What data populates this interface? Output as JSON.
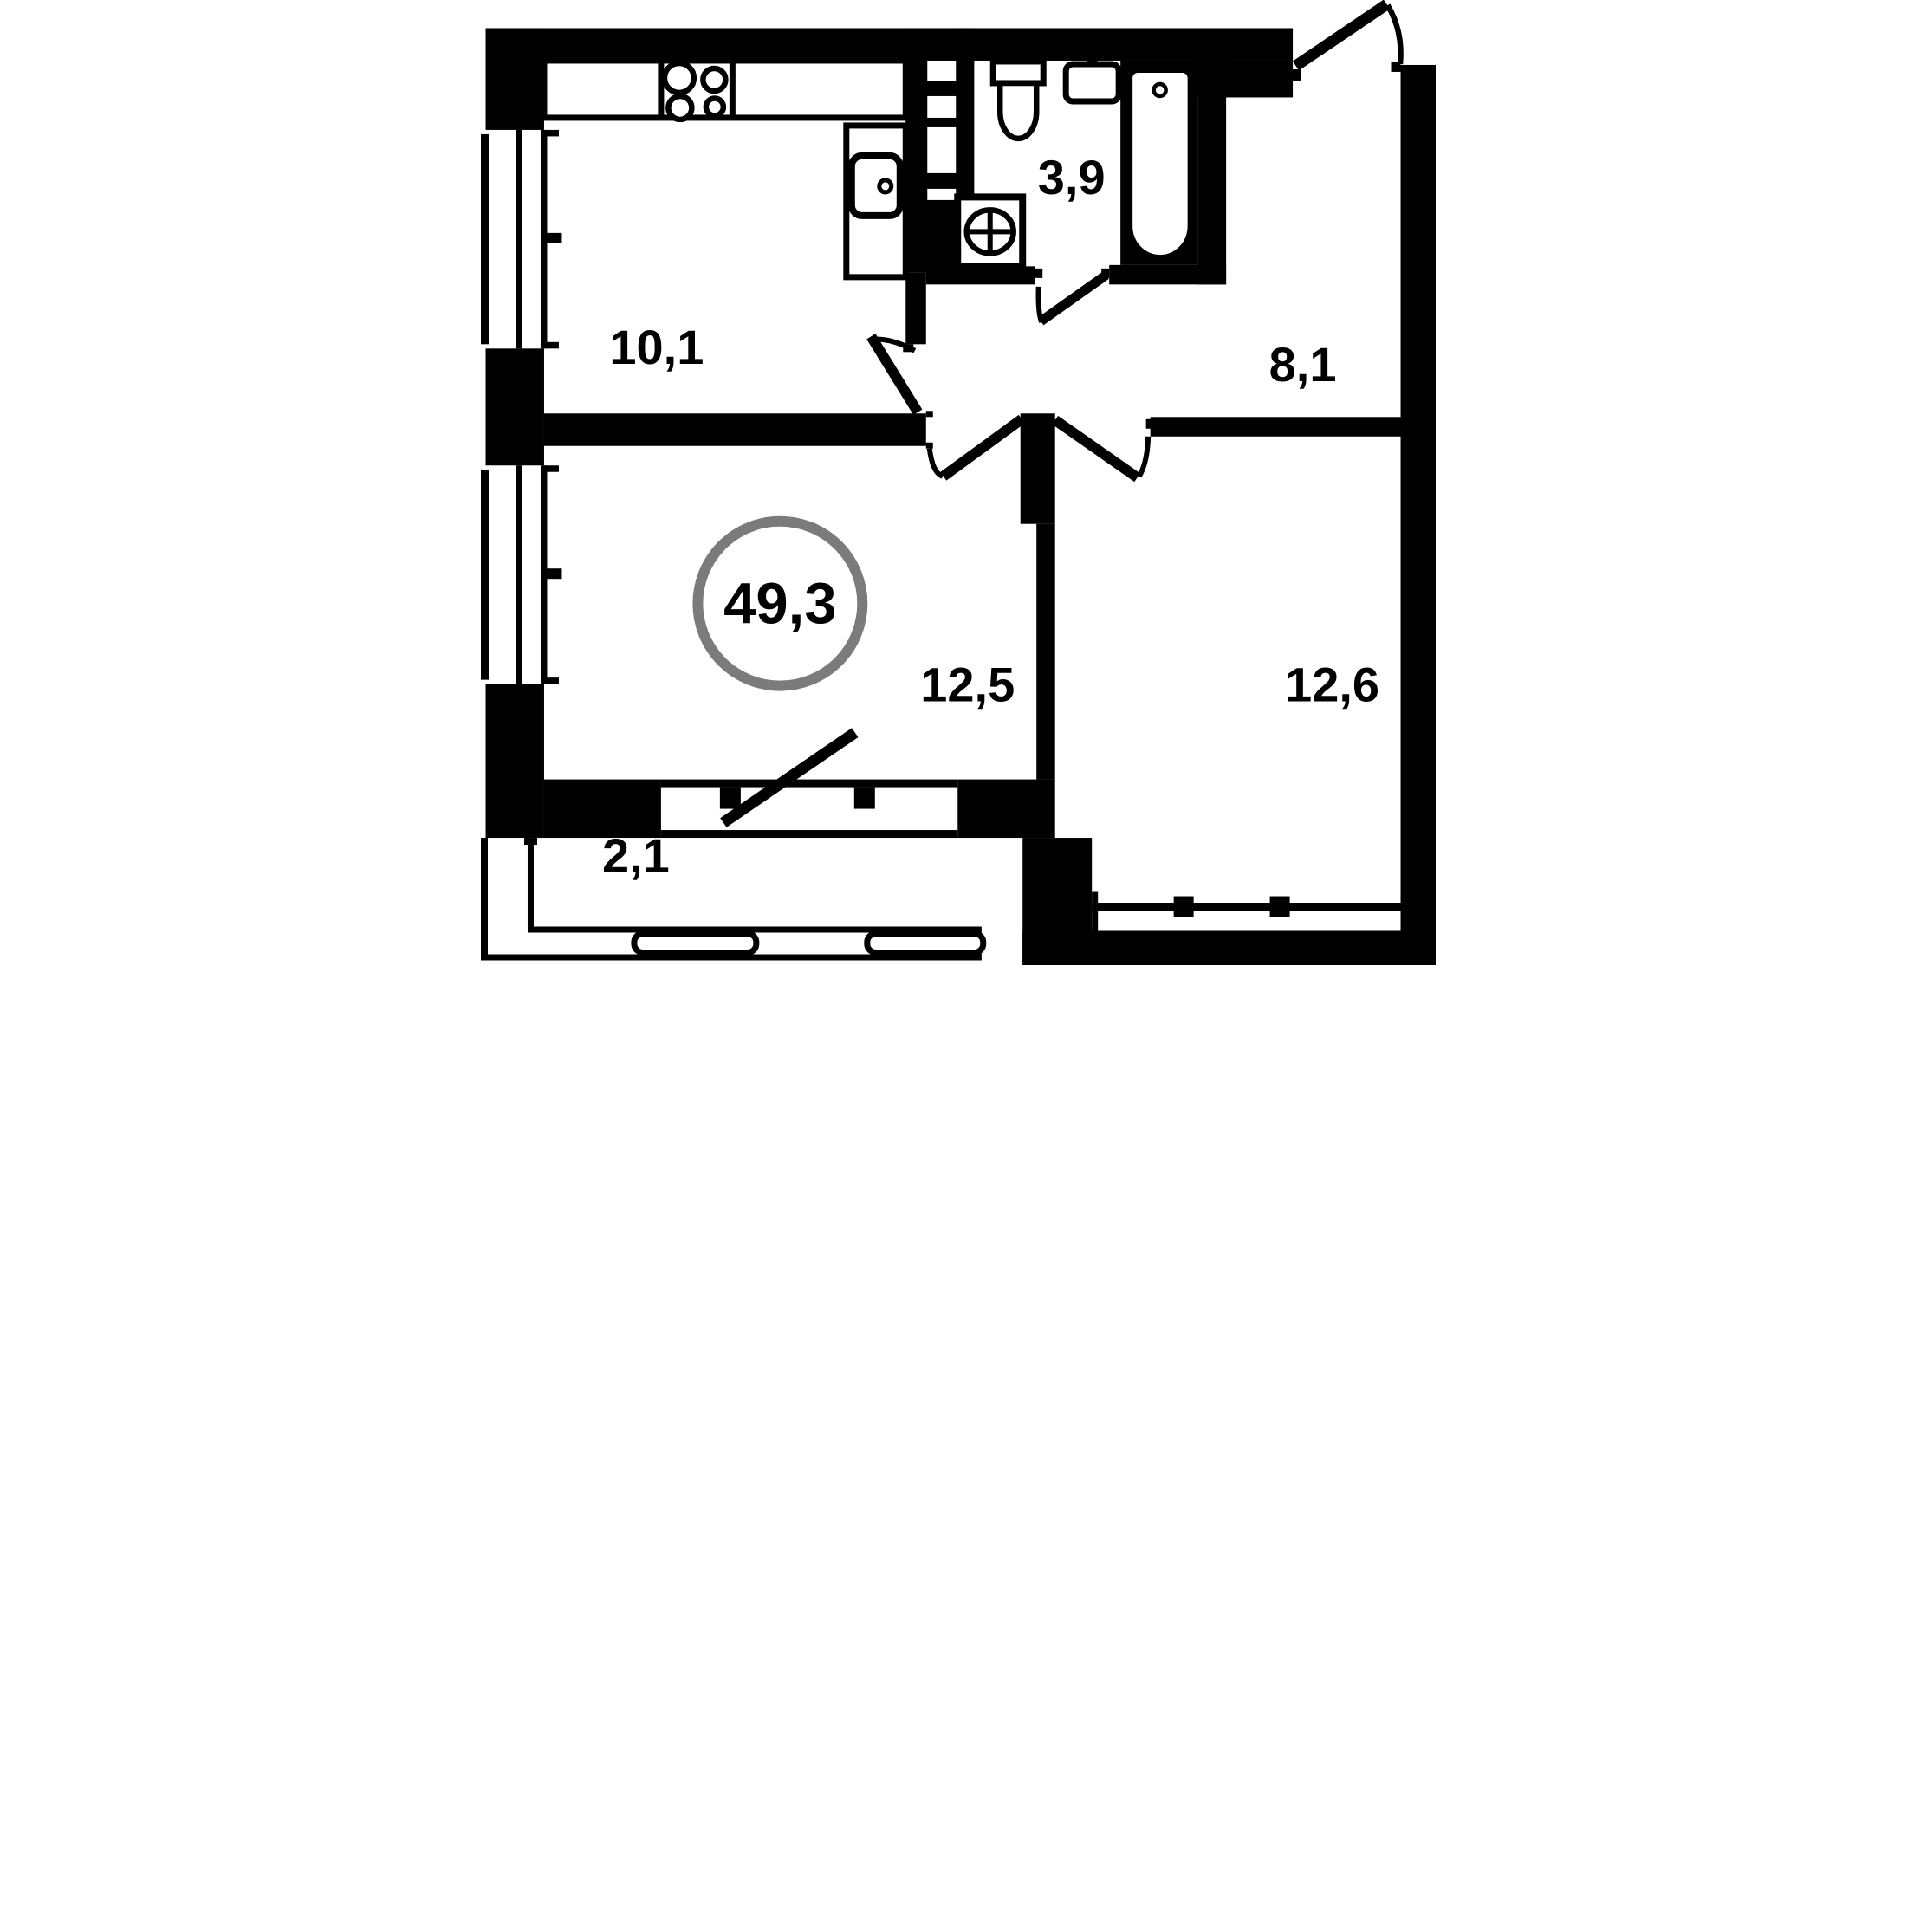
{
  "floorplan": {
    "type": "apartment-floor-plan",
    "total_area_label": "49,3",
    "rooms": [
      {
        "name": "kitchen",
        "area_label": "10,1"
      },
      {
        "name": "bathroom",
        "area_label": "3,9"
      },
      {
        "name": "hallway",
        "area_label": "8,1"
      },
      {
        "name": "room-a",
        "area_label": "12,5"
      },
      {
        "name": "room-b",
        "area_label": "12,6"
      },
      {
        "name": "balcony",
        "area_label": "2,1"
      }
    ],
    "fixtures": [
      "stove-icon",
      "kitchen-sink-icon",
      "toilet-icon",
      "washbasin-icon",
      "bathtub-icon",
      "washing-machine-icon"
    ],
    "colors": {
      "wall": "#000000",
      "bg": "#ffffff",
      "total_ring": "#7b7b7b"
    }
  }
}
